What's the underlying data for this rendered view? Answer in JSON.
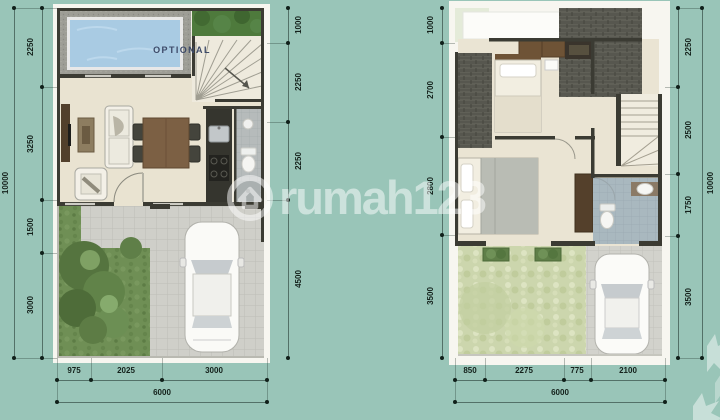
{
  "watermark": {
    "text": "rumah123",
    "logo": "circle-house-logo"
  },
  "floor1": {
    "pool_label": "OPTIONAL",
    "left_total": "10000",
    "left_dims": [
      "2250",
      "3250",
      "1500",
      "3000"
    ],
    "right_dims": [
      "1000",
      "2250",
      "2250",
      "4500"
    ],
    "bottom_dims": [
      "975",
      "2025",
      "3000"
    ],
    "bottom_total": "6000"
  },
  "floor2": {
    "left_dims": [
      "1000",
      "2700",
      "2800",
      "3500"
    ],
    "right_dims": [
      "2250",
      "2500",
      "1750",
      "3500"
    ],
    "right_total": "10000",
    "bottom_dims": [
      "850",
      "2275",
      "775",
      "2100"
    ],
    "bottom_total": "6000"
  },
  "colors": {
    "background": "#99c5b8",
    "wall": "#3b3b33",
    "pool_water": "#a9cbe3",
    "pool_text": "#3d4a68",
    "floor_cream": "#e9e3d1",
    "grass": "#6f8f55",
    "balcony_grass": "#ccd6ad",
    "paving": "#cfcfc9",
    "roof_shingle": "#57574f",
    "bath_tile": "#a9b8bf",
    "dimension_text": "#14211b",
    "watermark_white": "rgba(255,255,255,0.5)"
  }
}
